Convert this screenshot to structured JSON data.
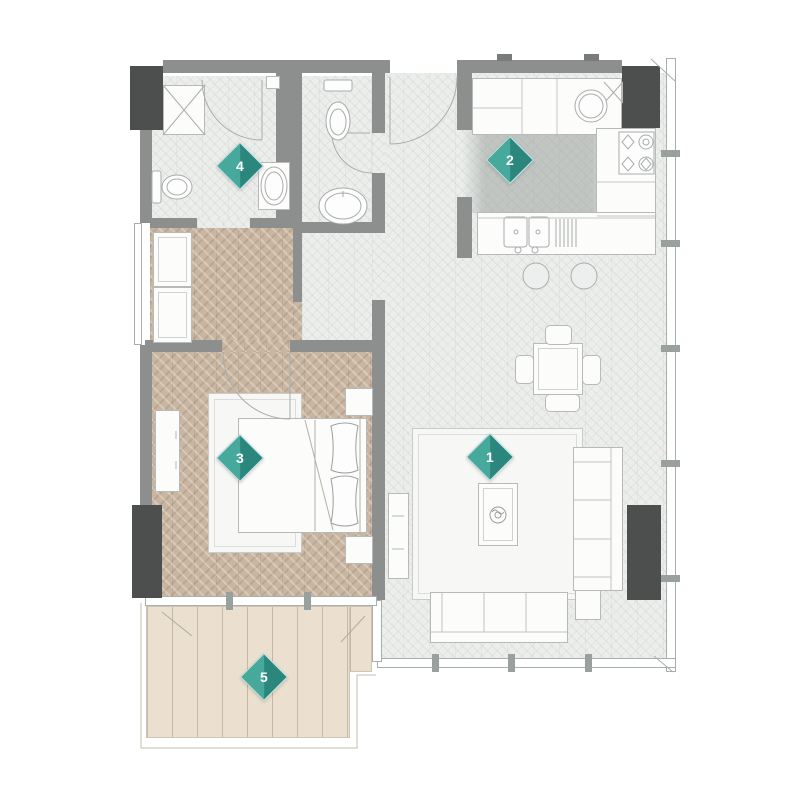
{
  "floorplan": {
    "markers": [
      {
        "label": "1",
        "room": "living-room"
      },
      {
        "label": "2",
        "room": "kitchen"
      },
      {
        "label": "3",
        "room": "bedroom"
      },
      {
        "label": "4",
        "room": "bathroom"
      },
      {
        "label": "5",
        "room": "balcony"
      }
    ],
    "colors": {
      "marker_teal_light": "#47a99c",
      "marker_teal_dark": "#2b877e",
      "wall_gray": "#8d8f8e",
      "column_dark_gray": "#4d4e4e",
      "bedroom_floor_tan": "#c9b6a1",
      "balcony_deck_tan": "#ebe0cf",
      "interior_floor_gray": "#eceeec"
    }
  }
}
